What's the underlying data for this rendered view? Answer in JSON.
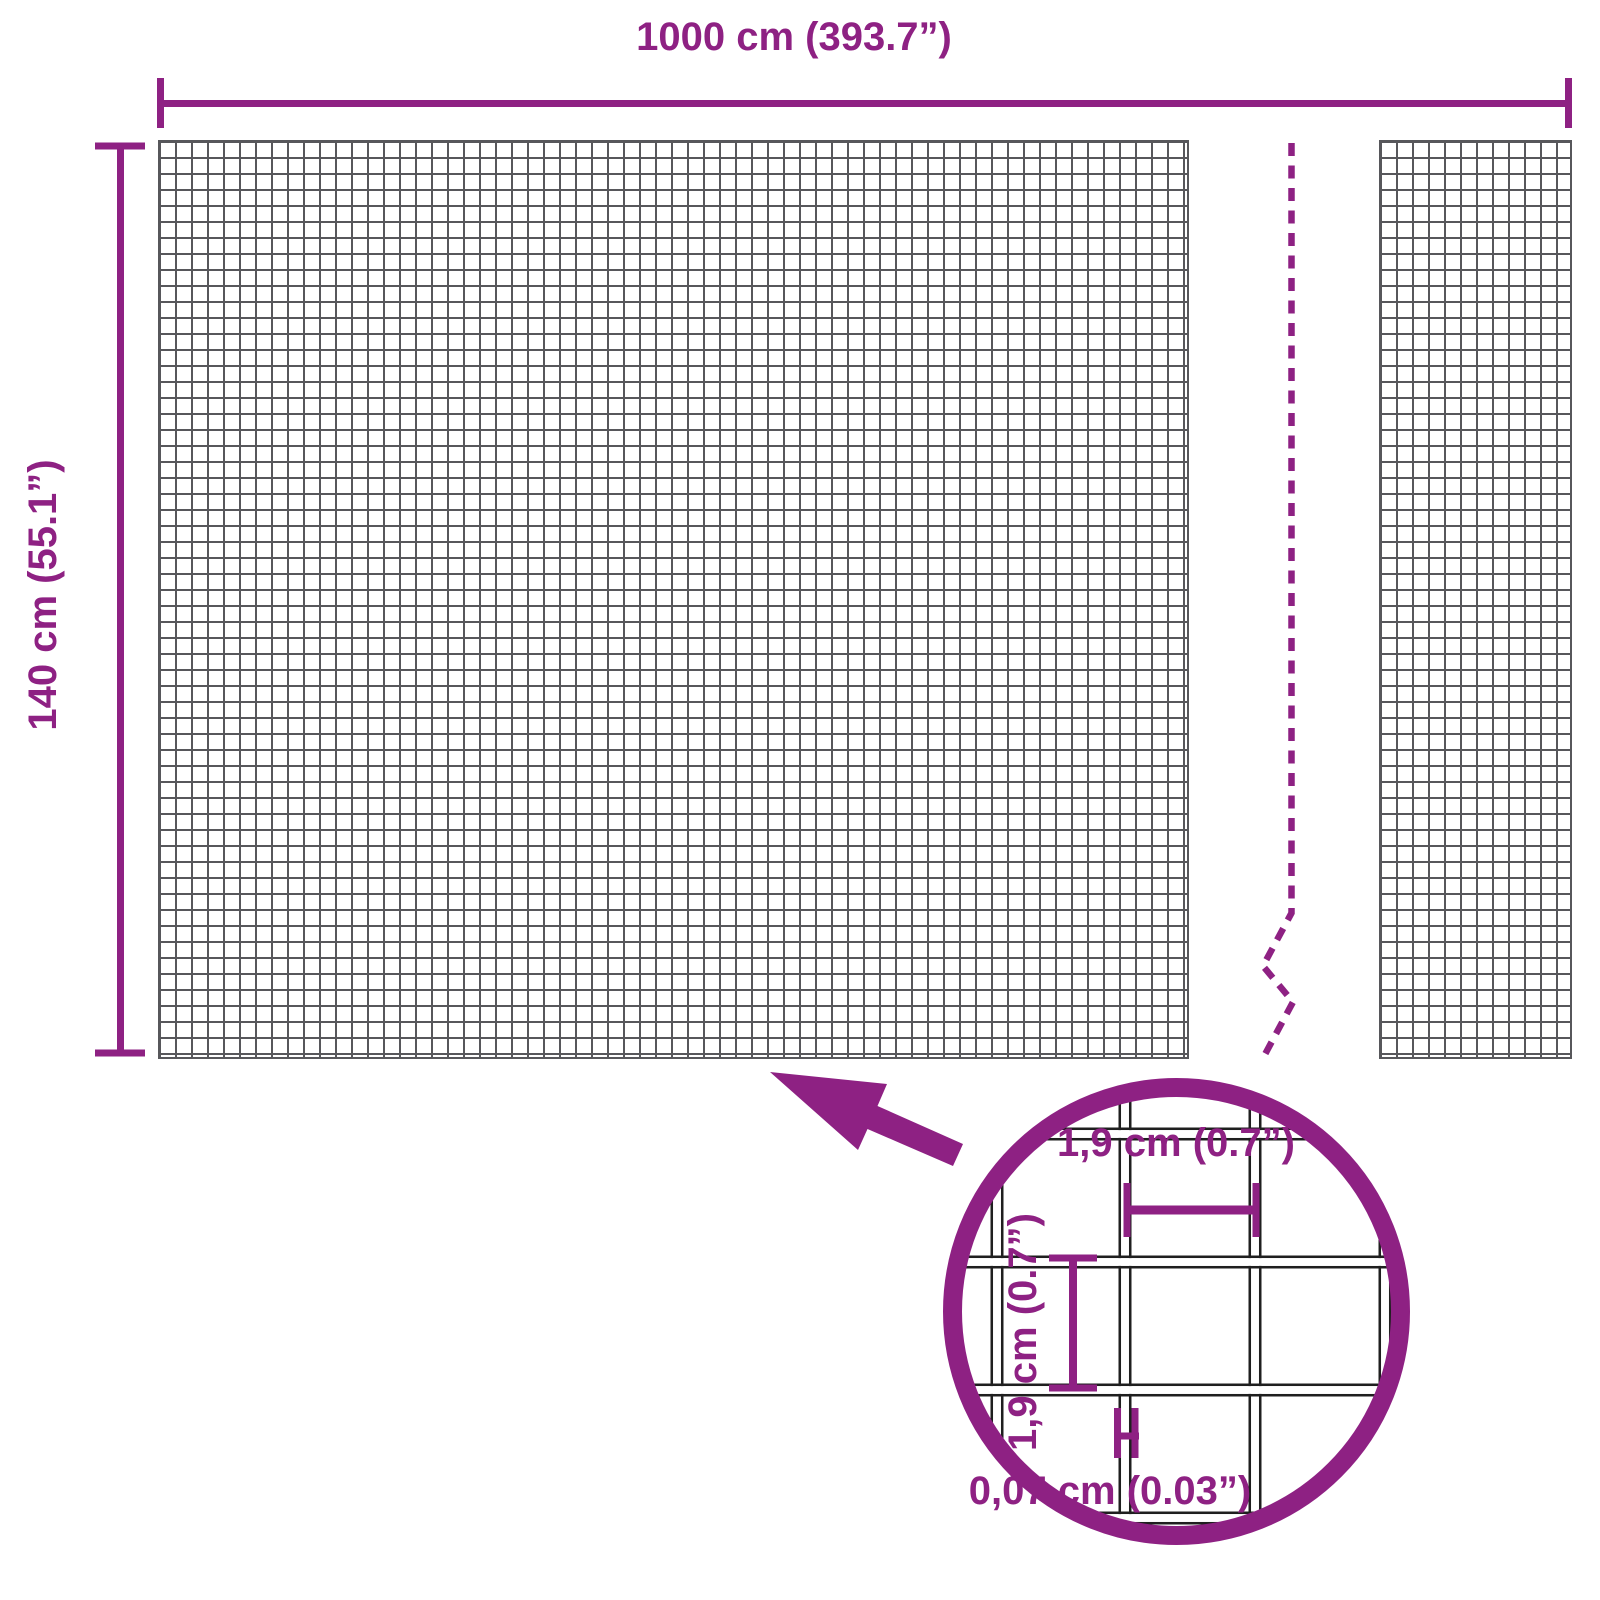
{
  "diagram": {
    "overall_width_label": "1000 cm (393.7”)",
    "overall_height_label": "140 cm (55.1”)",
    "detail": {
      "opening_width_label": "1,9 cm (0.7”)",
      "opening_height_label": "1,9 cm (0.7”)",
      "wire_thickness_label": "0,07 cm (0.03”)"
    }
  },
  "colors": {
    "accent_purple": "#8e2183",
    "mesh_line_gray": "#57575b",
    "wire_outline_dark": "#1f1f1f",
    "background": "#ffffff"
  },
  "icons": {
    "arrow": "zoom-pointer-arrow",
    "magnifier": "mesh-detail-magnifier-circle",
    "break": "panel-break-dashed-line"
  }
}
